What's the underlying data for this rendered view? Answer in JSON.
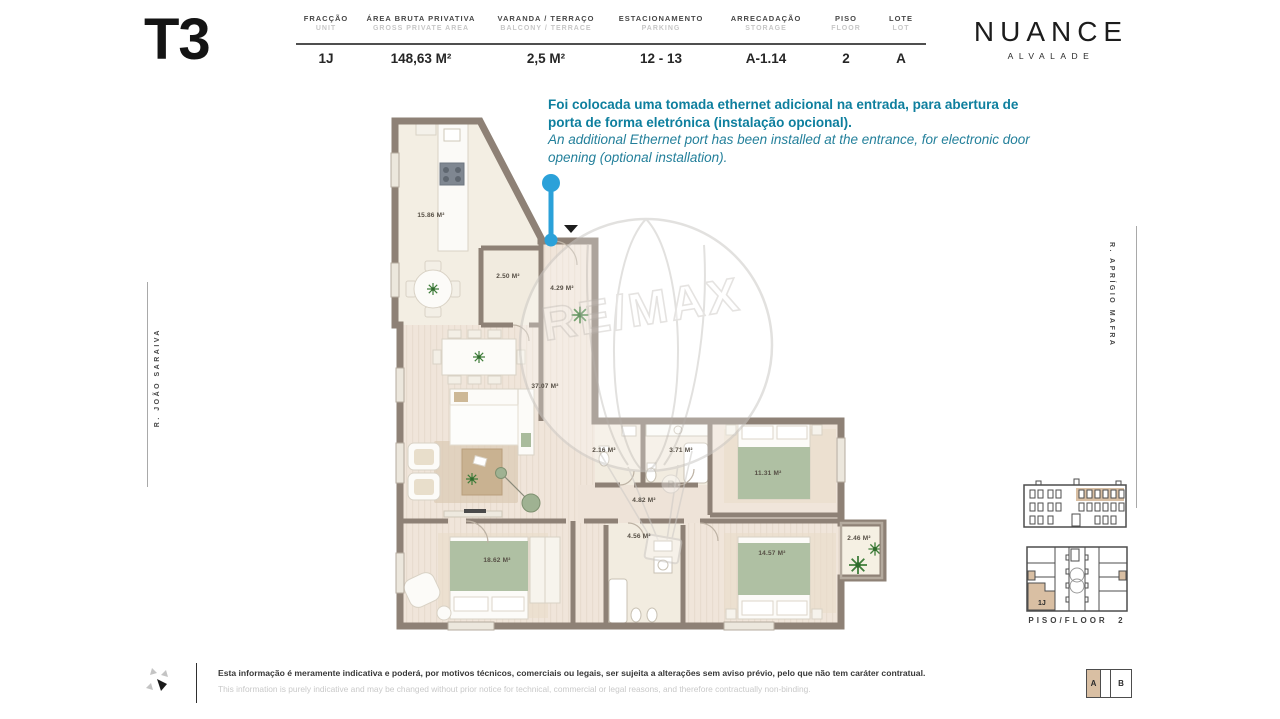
{
  "header": {
    "typology": "T3",
    "columns": [
      {
        "label_pt": "FRACÇÃO",
        "label_en": "UNIT",
        "value": "1J"
      },
      {
        "label_pt": "ÁREA BRUTA PRIVATIVA",
        "label_en": "GROSS PRIVATE AREA",
        "value": "148,63 M²"
      },
      {
        "label_pt": "VARANDA / TERRAÇO",
        "label_en": "BALCONY / TERRACE",
        "value": "2,5 M²"
      },
      {
        "label_pt": "ESTACIONAMENTO",
        "label_en": "PARKING",
        "value": "12 - 13"
      },
      {
        "label_pt": "ARRECADAÇÃO",
        "label_en": "STORAGE",
        "value": "A-1.14"
      },
      {
        "label_pt": "PISO",
        "label_en": "FLOOR",
        "value": "2"
      },
      {
        "label_pt": "LOTE",
        "label_en": "LOT",
        "value": "A"
      }
    ],
    "brand": {
      "name": "NUANCE",
      "location": "ALVALADE"
    }
  },
  "annotation": {
    "pt": "Foi colocada uma tomada ethernet adicional na entrada, para abertura de porta de forma eletrónica (instalação opcional).",
    "en": "An additional Ethernet port has been installed at the entrance, for electronic door opening (optional installation)."
  },
  "floorplan": {
    "watermark": "RE/MAX",
    "rooms": [
      {
        "name": "kitchen",
        "area": "15.86 M²"
      },
      {
        "name": "pantry",
        "area": "2.50 M²"
      },
      {
        "name": "entrance-hall",
        "area": "4.29 M²"
      },
      {
        "name": "living-room",
        "area": "37.07 M²"
      },
      {
        "name": "wc",
        "area": "2.16 M²"
      },
      {
        "name": "bathroom-1",
        "area": "3.71 M²"
      },
      {
        "name": "bedroom-1",
        "area": "11.31 M²"
      },
      {
        "name": "hallway",
        "area": "4.82 M²"
      },
      {
        "name": "bathroom-2",
        "area": "4.56 M²"
      },
      {
        "name": "bedroom-2",
        "area": "18.62 M²"
      },
      {
        "name": "bedroom-3",
        "area": "14.57 M²"
      },
      {
        "name": "balcony",
        "area": "2.46 M²"
      }
    ]
  },
  "streets": {
    "left": "R. JOÃO SARAIVA",
    "right": "R. APRÍGIO MAFRA"
  },
  "locator": {
    "floor_label": "PISO/FLOOR",
    "floor_value": "2",
    "unit_label": "1J",
    "lot_a": "A",
    "lot_b": "B"
  },
  "footer": {
    "disclaimer_pt": "Esta informação é meramente indicativa e poderá, por motivos técnicos, comerciais ou legais, ser sujeita a alterações sem aviso prévio, pelo que não tem caráter contratual.",
    "disclaimer_en": "This information is purely indicative and may be changed without prior notice for technical, commercial or legal reasons, and therefore contractually non-binding."
  },
  "colors": {
    "annotation_teal": "#0e7f9e",
    "marker_blue": "#2ba1d9",
    "wall_taupe": "#8e8176",
    "highlight_tan": "#d9bfa3"
  }
}
